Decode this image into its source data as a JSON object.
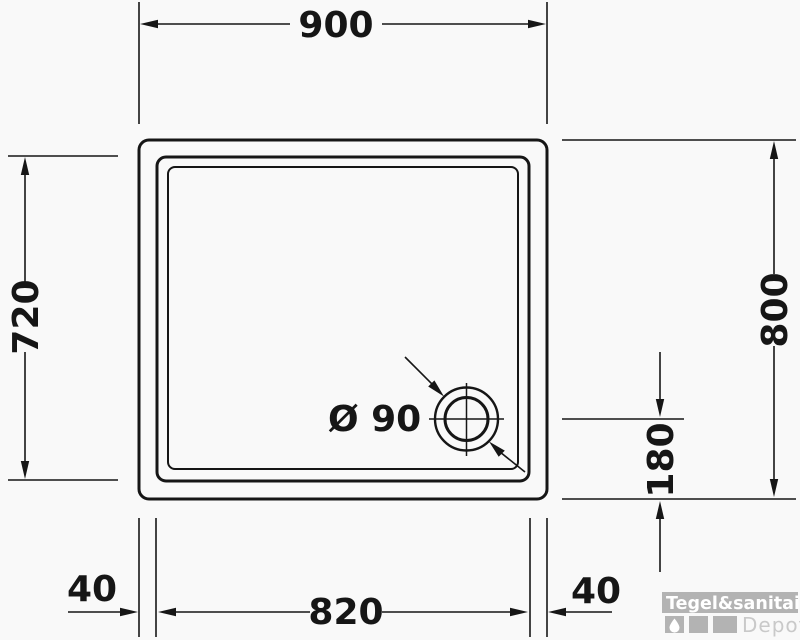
{
  "drawing": {
    "type": "shower-tray-technical-top-view",
    "labels": {
      "width_outer": "900",
      "height_inner": "720",
      "height_outer": "800",
      "drain_offset_bottom": "180",
      "rim_left": "40",
      "width_inner": "820",
      "rim_right": "40",
      "drain_diameter": "Ø 90"
    },
    "colors": {
      "line": "#161616",
      "background": "#f9f9f9",
      "logo_gray": "#b3b3b3",
      "logo_sub_text": "#c9c9c9",
      "logo_brand_text": "#ffffff"
    }
  },
  "logo": {
    "brand": "Tegel&sanitair",
    "sub": "Depot"
  }
}
